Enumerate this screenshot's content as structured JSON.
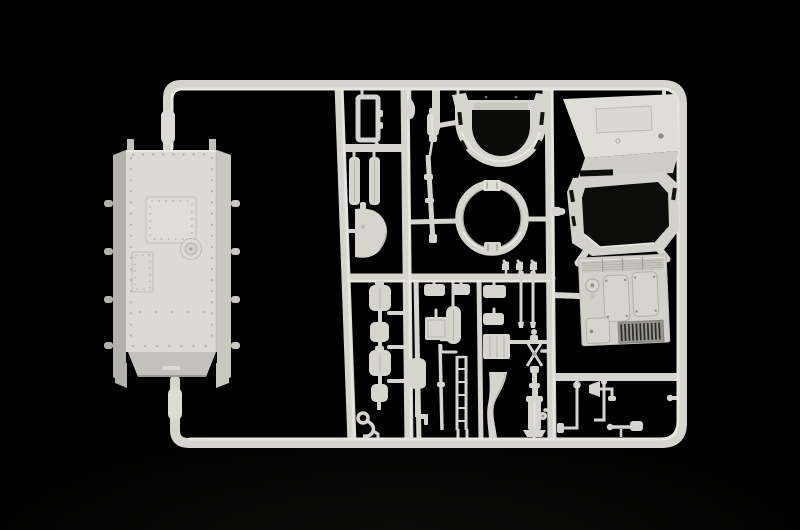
{
  "scene": {
    "description": "Black-background studio photograph of a light grey injection-moulded model-kit sprue (parts frame) for an armoured vehicle: a riveted hull tub on the left, and inside the runner frame a horseshoe turret shell, a turret ring with clamp tabs, a cab superstructure with a dark octagonal turret opening, an engine deck with louvers and grille, plus many small fittings (boxes, shovel, barrel, planks, jacks, pipes).",
    "background_color": "#000000",
    "vignette_color": "#3c3c36",
    "sprue": {
      "plastic_color": "#d6d5cd",
      "highlight_color": "#e6e5de",
      "shadow_color": "#b4b3ab",
      "dark_plastic_color": "#b3b2aa",
      "opening_color": "#0b0b09",
      "runner_layout": "outer frame with rounded right-hand corners, three inner vertical runners and horizontal cross-runners; hull attached by gates on the left"
    },
    "parts": [
      {
        "name": "hull-tub",
        "description": "large riveted hull plate with square hatch, small panel, round cap, side rails and axle stubs"
      },
      {
        "name": "turret-shell",
        "description": "horseshoe-shaped turret body with corner horns and side slots"
      },
      {
        "name": "turret-ring",
        "description": "circular ring with square clamp tabs top and bottom"
      },
      {
        "name": "superstructure",
        "description": "cab roof panel over octagonal turret-opening frame"
      },
      {
        "name": "engine-deck",
        "description": "deck plate with louver strip, two long hatches, square hatch, round cap and dark grille"
      },
      {
        "name": "open-frame",
        "description": "small open rectangular frame"
      },
      {
        "name": "plank-pair",
        "description": "two flat strips with centre seams"
      },
      {
        "name": "fender",
        "description": "D-shaped half disc with top peg"
      },
      {
        "name": "teardrop-knob",
        "description": "small teardrop-shaped knob"
      },
      {
        "name": "muffler",
        "description": "small stepped cylinder"
      },
      {
        "name": "gun-barrel",
        "description": "long thin rod with collar bands"
      },
      {
        "name": "stowage-box-chain",
        "description": "vertical chain of four rounded boxes with T-links"
      },
      {
        "name": "s-hook",
        "description": "S-shaped hook with eye"
      },
      {
        "name": "small-box-row",
        "description": "row of small rounded boxes under cross runner"
      },
      {
        "name": "square-plate",
        "description": "small square plate with border"
      },
      {
        "name": "canteen",
        "description": "rounded vertical canister"
      },
      {
        "name": "shovel",
        "description": "dome-bladed shovel with shaft and bracket"
      },
      {
        "name": "thin-rod",
        "description": "thin rod with band"
      },
      {
        "name": "ladder",
        "description": "two rails with rungs"
      },
      {
        "name": "curved-board",
        "description": "board with S-curved waist"
      },
      {
        "name": "ribbed-plate",
        "description": "small ribbed plate"
      },
      {
        "name": "periscope-trio",
        "description": "three small periscope heads on runner"
      },
      {
        "name": "hanging-rod-pair",
        "description": "two thin rods with ball heads"
      },
      {
        "name": "scissor-linkage",
        "description": "X-arm linkage with pivot"
      },
      {
        "name": "bottle-jack",
        "description": "jack body on base plate with side wheel"
      },
      {
        "name": "corner-fittings",
        "description": "thin rods, horn funnel, elbows and brackets in bottom-right cell"
      }
    ]
  }
}
